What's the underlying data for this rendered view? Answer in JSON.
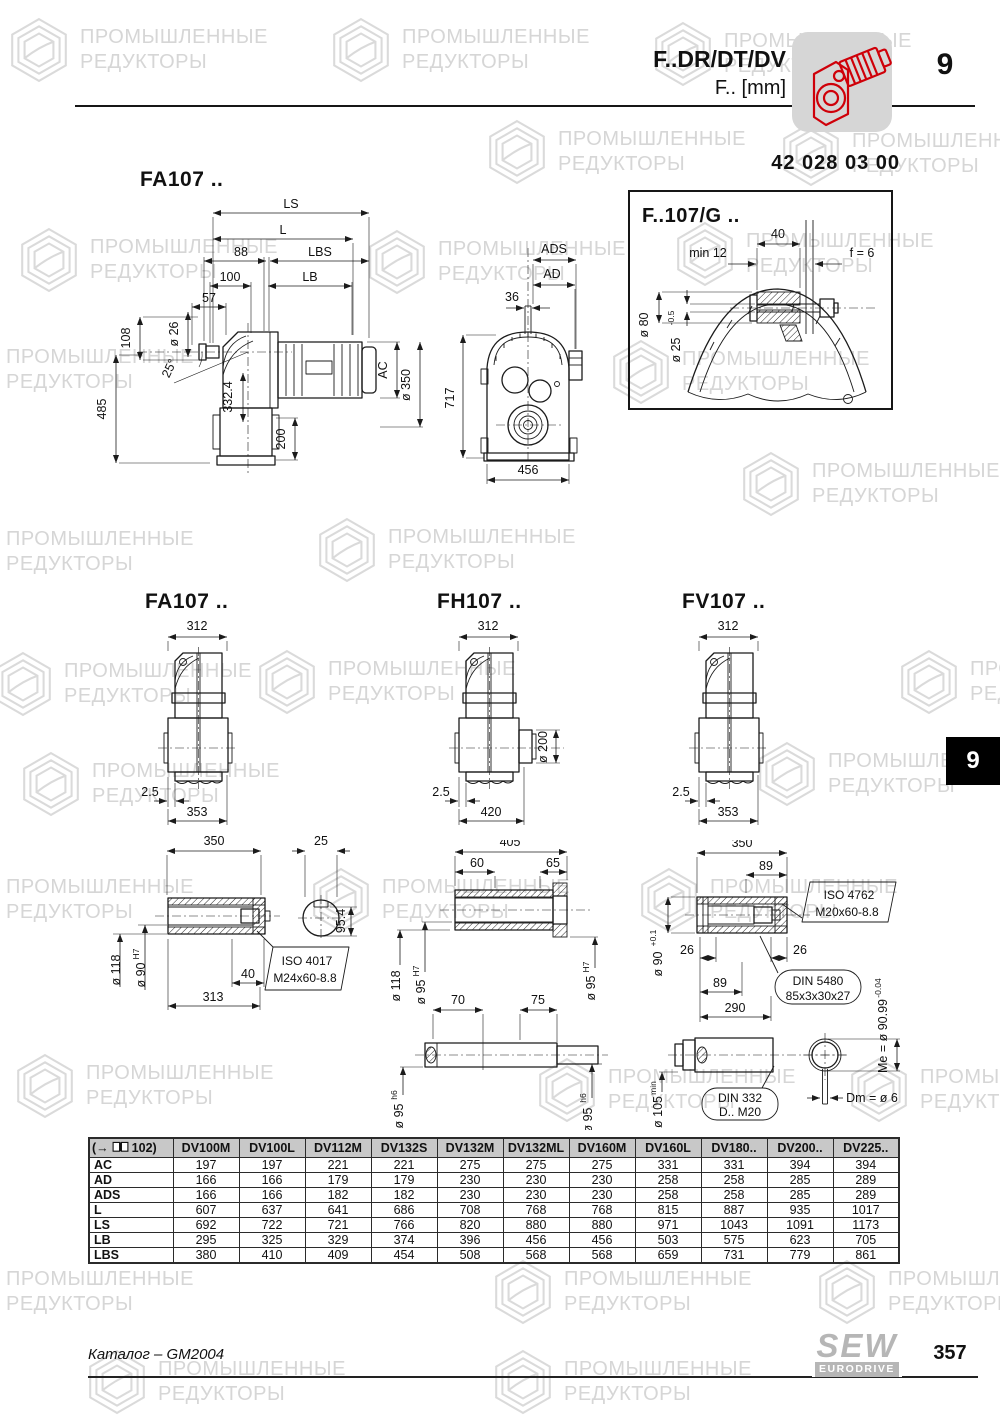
{
  "watermark": {
    "line1": "ПРОМЫШЛЕННЫЕ",
    "line2": "РЕДУКТОРЫ"
  },
  "header": {
    "model": "F..DR/DT/DV",
    "unit": "F.. [mm]",
    "chapter": "9",
    "part_number": "42 028 03 00"
  },
  "side_tab": "9",
  "main_view": {
    "title": "FA107 ..",
    "ls": "LS",
    "l": "L",
    "d88": "88",
    "lbs": "LBS",
    "d100": "100",
    "lb": "LB",
    "d57": "57",
    "d108": "108",
    "d26": "ø 26",
    "angle": "25°",
    "d485": "485",
    "d332": "332.4",
    "d200": "200",
    "ac": "AC",
    "d350": "ø 350"
  },
  "front_view": {
    "ads": "ADS",
    "ad": "AD",
    "d36": "36",
    "d717": "717",
    "d456": "456"
  },
  "inset": {
    "title": "F..107/G ..",
    "d40": "40",
    "min12": "min 12",
    "f6": "f = 6",
    "d80": "ø 80",
    "d25": "ø 25",
    "d25_tol": "-0.5"
  },
  "small_views": {
    "fa": {
      "title": "FA107 ..",
      "top": "312",
      "offset": "2.5",
      "bottom": "353"
    },
    "fh": {
      "title": "FH107 ..",
      "top": "312",
      "offset": "2.5",
      "bottom": "420",
      "flange": "ø 200"
    },
    "fv": {
      "title": "FV107 ..",
      "top": "312",
      "offset": "2.5",
      "bottom": "353"
    }
  },
  "shaft_a": {
    "d350": "350",
    "d25": "25",
    "d954": "95.4",
    "d118": "ø 118",
    "d90": "ø 90",
    "d90_fit": "H7",
    "d40": "40",
    "d313": "313",
    "callout1": "ISO 4017",
    "callout2": "M24x60-8.8"
  },
  "shaft_h": {
    "d405": "405",
    "d60": "60",
    "d65": "65",
    "d118": "ø 118",
    "d95l": "ø 95",
    "d95l_fit": "H7",
    "d95r": "ø 95",
    "d95r_fit": "H7",
    "d70": "70",
    "d75": "75",
    "d95bl": "ø 95",
    "d95bl_fit": "h6",
    "d95br": "ø 95",
    "d95br_fit": "h6"
  },
  "shaft_v": {
    "d350": "350",
    "d89a": "89",
    "iso1": "ISO 4762",
    "iso2": "M20x60-8.8",
    "d26l": "26",
    "d26r": "26",
    "d89b": "89",
    "d290": "290",
    "d90": "ø 90",
    "d90_tol": "+0.1",
    "din1": "DIN 5480",
    "din2": "85x3x30x27",
    "me": "Me = ø 90.99",
    "me_tol": "-0.04",
    "d105": "ø 105",
    "d105_suffix": "min",
    "din332a": "DIN 332",
    "din332b": "D.. M20",
    "dm": "Dm = ø 6"
  },
  "table": {
    "ref_open": "(→",
    "ref_page": "102)",
    "columns": [
      "DV100M",
      "DV100L",
      "DV112M",
      "DV132S",
      "DV132M",
      "DV132ML",
      "DV160M",
      "DV160L",
      "DV180..",
      "DV200..",
      "DV225.."
    ],
    "rows": [
      {
        "label": "AC",
        "values": [
          "197",
          "197",
          "221",
          "221",
          "275",
          "275",
          "275",
          "331",
          "331",
          "394",
          "394"
        ]
      },
      {
        "label": "AD",
        "values": [
          "166",
          "166",
          "179",
          "179",
          "230",
          "230",
          "230",
          "258",
          "258",
          "285",
          "289"
        ]
      },
      {
        "label": "ADS",
        "values": [
          "166",
          "166",
          "182",
          "182",
          "230",
          "230",
          "230",
          "258",
          "258",
          "285",
          "289"
        ]
      },
      {
        "label": "L",
        "values": [
          "607",
          "637",
          "641",
          "686",
          "708",
          "768",
          "768",
          "815",
          "887",
          "935",
          "1017"
        ]
      },
      {
        "label": "LS",
        "values": [
          "692",
          "722",
          "721",
          "766",
          "820",
          "880",
          "880",
          "971",
          "1043",
          "1091",
          "1173"
        ]
      },
      {
        "label": "LB",
        "values": [
          "295",
          "325",
          "329",
          "374",
          "396",
          "456",
          "456",
          "503",
          "575",
          "623",
          "705"
        ]
      },
      {
        "label": "LBS",
        "values": [
          "380",
          "410",
          "409",
          "454",
          "508",
          "568",
          "568",
          "659",
          "731",
          "779",
          "861"
        ]
      }
    ]
  },
  "footer": {
    "catalog": "Каталог – GM2004",
    "page": "357",
    "logo_top": "SEW",
    "logo_bottom": "EURODRIVE"
  }
}
